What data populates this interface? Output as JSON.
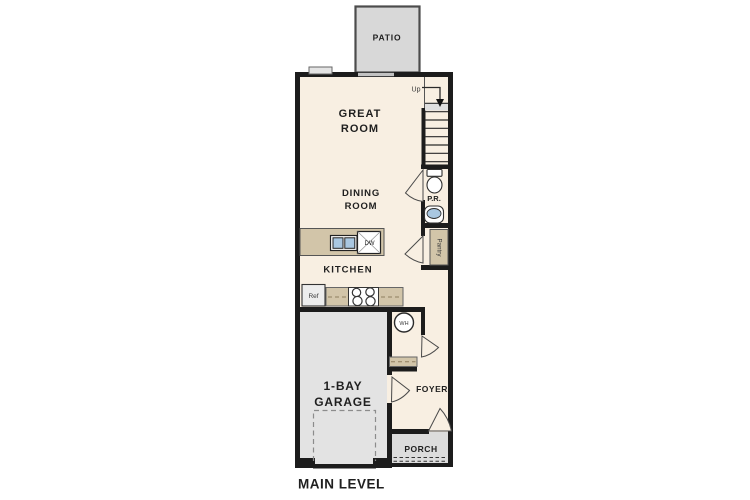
{
  "plan_title": "MAIN LEVEL",
  "rooms": {
    "patio": "PATIO",
    "great_room": {
      "line1": "GREAT",
      "line2": "ROOM"
    },
    "dining_room": {
      "line1": "DINING",
      "line2": "ROOM"
    },
    "kitchen": "KITCHEN",
    "powder_room": "P.R.",
    "pantry": "Pantry",
    "garage": {
      "line1": "1-BAY",
      "line2": "GARAGE"
    },
    "foyer": "FOYER",
    "porch": "PORCH"
  },
  "labels": {
    "stairs_up": "Up",
    "refrigerator": "Ref",
    "dishwasher": "DW",
    "water_heater": "WH"
  },
  "colors": {
    "wall": "#1c1c1c",
    "interior": "#f8efe2",
    "garage_floor": "#e3e3e3",
    "patio": "#d8d8d8",
    "porch": "#dcdcdc",
    "casework": "#d2c5a9",
    "fixture_blue": "#a9c7e1"
  }
}
